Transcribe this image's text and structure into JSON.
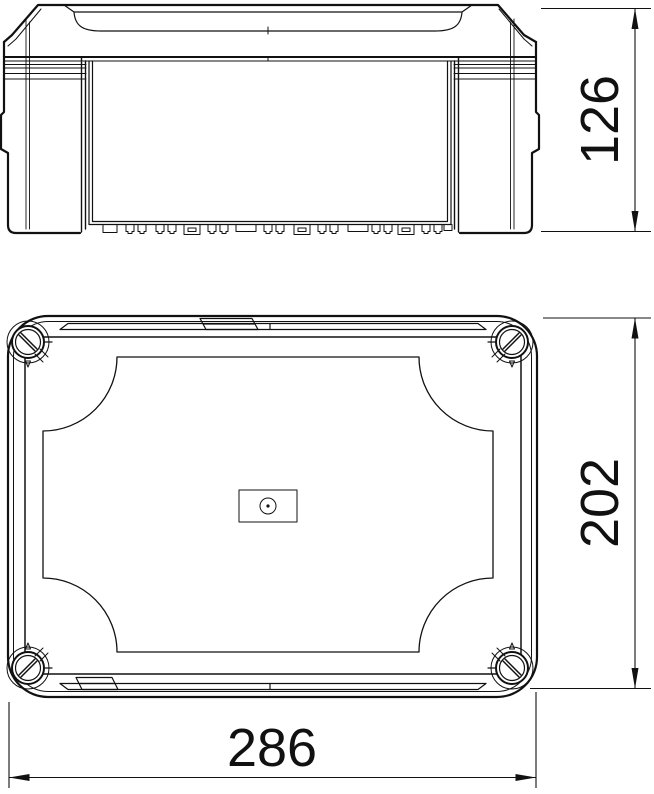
{
  "style": {
    "background": "#ffffff",
    "line_color": "#111111"
  },
  "dimensions": {
    "height_label": "126",
    "depth_label": "202",
    "width_label": "286"
  },
  "icons": {
    "screw": "slotted-corner-screw-icon",
    "arrow_up": "arrow-up-icon",
    "arrow_down": "arrow-down-icon",
    "arrow_left": "arrow-left-icon",
    "arrow_right": "arrow-right-icon"
  }
}
